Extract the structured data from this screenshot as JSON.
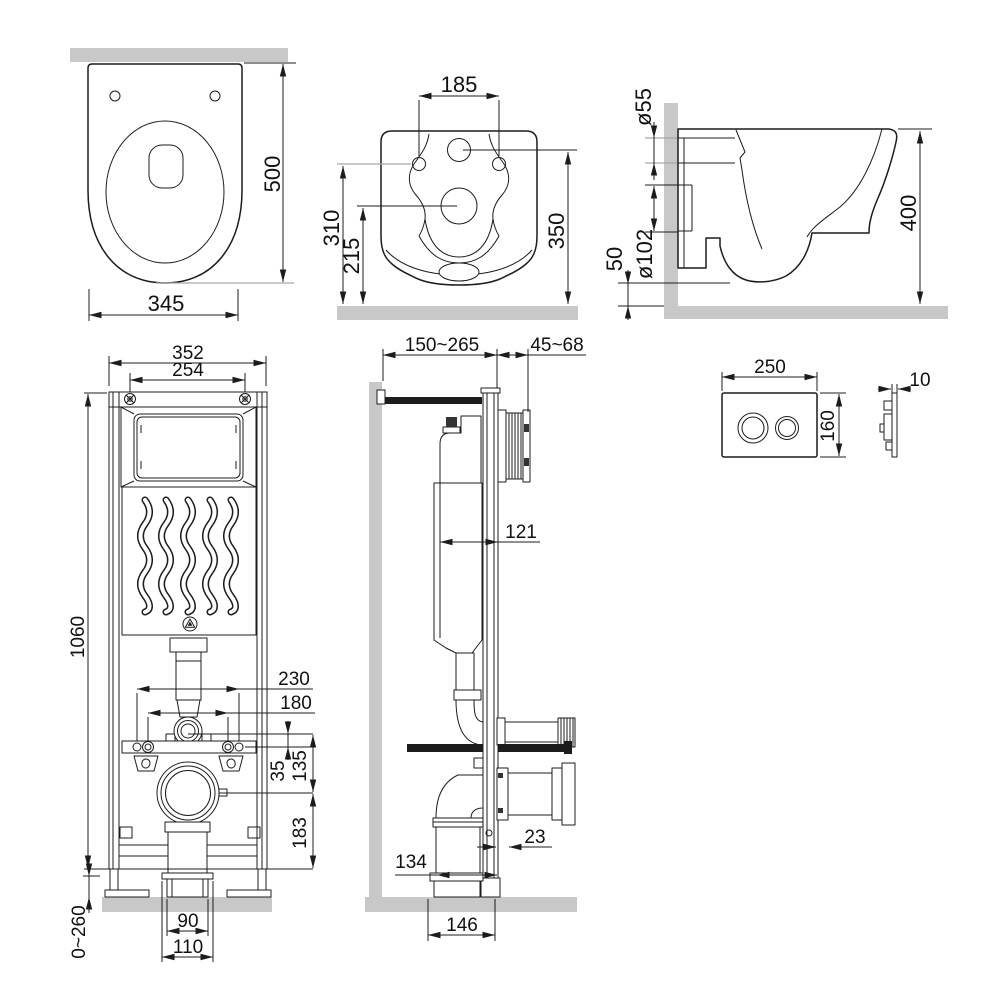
{
  "drawing": {
    "type": "technical installation drawing",
    "subject": "wall-hung toilet with concealed cistern frame and flush plate",
    "units": "mm"
  },
  "colors": {
    "line": "#1c1c1c",
    "wall_fill": "#c8c8c8",
    "leader_line": "#a6a6a6",
    "background": "#ffffff"
  },
  "views": {
    "toilet_top": {
      "name": "toilet top view",
      "depth": "500",
      "width": "345"
    },
    "toilet_rear": {
      "name": "toilet rear view",
      "hole_spacing": "185",
      "holes_height": "310",
      "drain_height": "215",
      "inlet_height": "350"
    },
    "toilet_side": {
      "name": "toilet side view",
      "inlet_dia": "ø55",
      "outlet_dia": "ø102",
      "outlet_height": "50",
      "depth": "400"
    },
    "frame_front": {
      "name": "installation frame front view",
      "width": "352",
      "screw_spacing": "254",
      "height": "1060",
      "bolt_outer": "230",
      "bolt_inner": "180",
      "flush_offset": "35",
      "flush_to_drain": "135",
      "drain_to_base": "183",
      "leg_range": "0~260",
      "pipe_width": "90",
      "flange_width": "110"
    },
    "frame_side": {
      "name": "installation frame side view",
      "wall_distance": "150~265",
      "finish_range": "45~68",
      "tank_depth": "121",
      "profile_depth": "23",
      "pipe_offset": "134",
      "base_depth": "146"
    },
    "flush_plate": {
      "name": "flush plate views",
      "width": "250",
      "height": "160",
      "thickness": "10"
    }
  }
}
